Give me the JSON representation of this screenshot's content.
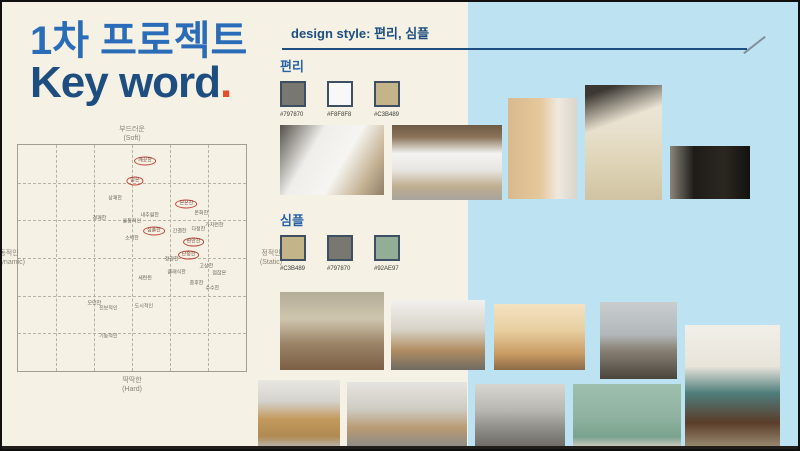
{
  "slide": {
    "title_line1": "1차 프로젝트",
    "title_line2": "Key word",
    "title_period": ".",
    "header": "design style: 편리, 심플"
  },
  "palette_sections": [
    {
      "label": "편리",
      "swatches": [
        "#797870",
        "#F8F8F8",
        "#C3B489"
      ]
    },
    {
      "label": "심플",
      "swatches": [
        "#C3B489",
        "#797870",
        "#92AE97"
      ]
    }
  ],
  "image_scale_map": {
    "axis_top_ko": "부드러운",
    "axis_top_en": "(Soft)",
    "axis_bottom_ko": "딱딱한",
    "axis_bottom_en": "(Hard)",
    "axis_left_ko": "동적인",
    "axis_left_en": "(Dynamic)",
    "axis_right_ko": "정적인",
    "axis_right_en": "(Static)",
    "words": [
      {
        "label": "깨끗한",
        "x": 55.7,
        "y": 7.0,
        "circled": true
      },
      {
        "label": "맑은",
        "x": 51.3,
        "y": 15.8,
        "circled": true
      },
      {
        "label": "상쾌한",
        "x": 42.6,
        "y": 23.7,
        "circled": false
      },
      {
        "label": "은은한",
        "x": 73.9,
        "y": 25.9,
        "circled": true
      },
      {
        "label": "온화한",
        "x": 80.4,
        "y": 30.7,
        "circled": false
      },
      {
        "label": "경쾌한",
        "x": 35.7,
        "y": 32.9,
        "circled": false
      },
      {
        "label": "내추럴한",
        "x": 57.8,
        "y": 31.6,
        "circled": false
      },
      {
        "label": "율동적인",
        "x": 50.0,
        "y": 34.2,
        "circled": false
      },
      {
        "label": "가지런한",
        "x": 86.1,
        "y": 36.0,
        "circled": false
      },
      {
        "label": "심플한",
        "x": 59.6,
        "y": 38.2,
        "circled": true
      },
      {
        "label": "간결한",
        "x": 70.9,
        "y": 38.6,
        "circled": false
      },
      {
        "label": "다정한",
        "x": 79.1,
        "y": 37.7,
        "circled": false
      },
      {
        "label": "소박한",
        "x": 50.0,
        "y": 41.7,
        "circled": false
      },
      {
        "label": "편안한",
        "x": 77.0,
        "y": 43.0,
        "circled": true
      },
      {
        "label": "정갈한",
        "x": 67.4,
        "y": 50.9,
        "circled": false
      },
      {
        "label": "단정한",
        "x": 74.8,
        "y": 48.7,
        "circled": true
      },
      {
        "label": "고상한",
        "x": 82.6,
        "y": 53.9,
        "circled": false
      },
      {
        "label": "점잖은",
        "x": 88.3,
        "y": 57.0,
        "circled": false
      },
      {
        "label": "클래식한",
        "x": 69.6,
        "y": 56.6,
        "circled": false
      },
      {
        "label": "세련된",
        "x": 55.7,
        "y": 59.2,
        "circled": false
      },
      {
        "label": "중후한",
        "x": 78.3,
        "y": 61.4,
        "circled": false
      },
      {
        "label": "수수한",
        "x": 85.2,
        "y": 63.6,
        "circled": false
      },
      {
        "label": "모던한",
        "x": 33.5,
        "y": 70.2,
        "circled": false
      },
      {
        "label": "진보적인",
        "x": 39.6,
        "y": 72.4,
        "circled": false
      },
      {
        "label": "도시적인",
        "x": 55.2,
        "y": 71.5,
        "circled": false
      },
      {
        "label": "기능적인",
        "x": 39.6,
        "y": 85.1,
        "circled": false
      }
    ]
  },
  "colors": {
    "background_cream": "#F5F1E4",
    "panel_blue": "#BDE3F2",
    "title_blue": "#2B6CB8",
    "navy": "#1D4E7F",
    "accent_orange": "#E0502D",
    "circle_red": "#C0453A"
  }
}
